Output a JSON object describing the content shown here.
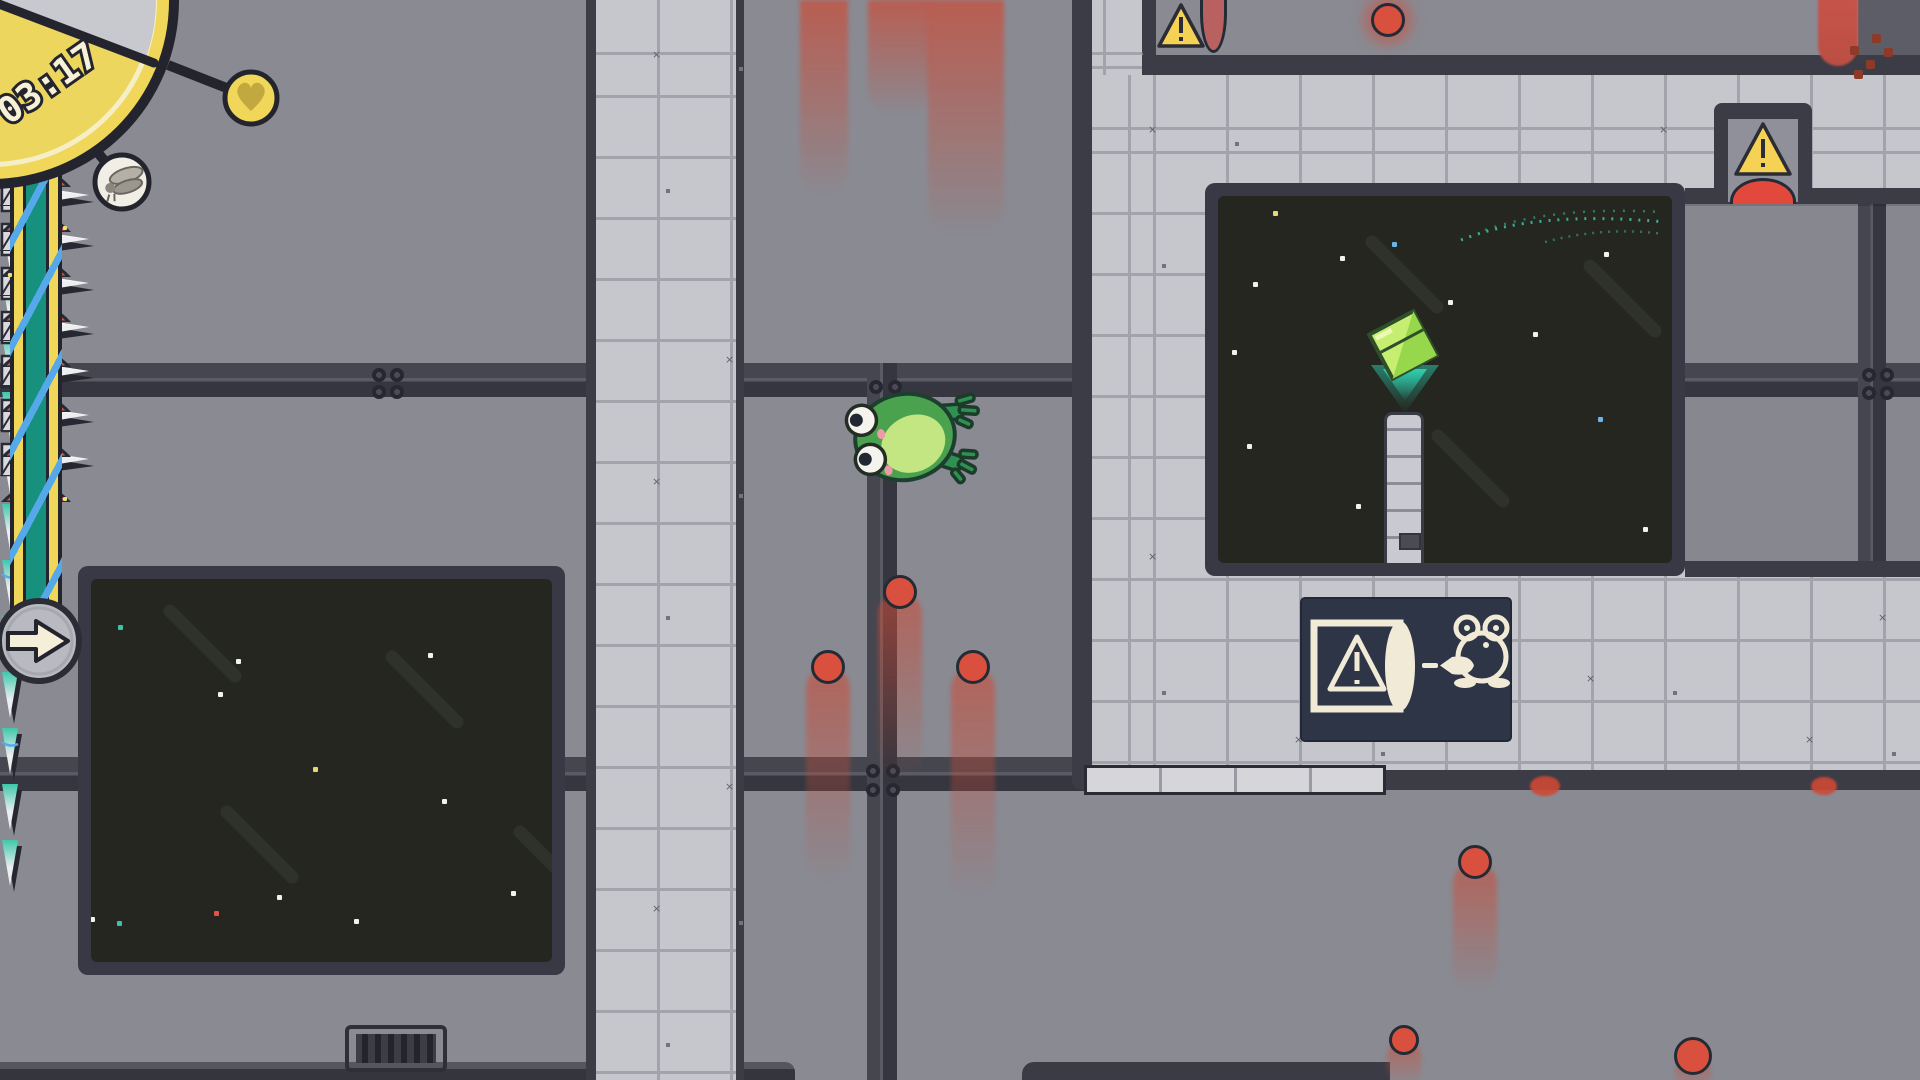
{
  "hud": {
    "timer": "03:17",
    "timer_clock_icon": "analog-clock-face",
    "heart_icon": "heart",
    "fly_icon": "fly-wings",
    "arrow_icon": "right-arrow",
    "colors": {
      "clock_face": "#ecd65e",
      "clock_ring": "#f0d75a",
      "clock_elapsed": "#c8c8cf",
      "outline": "#23242e",
      "ribbon_teal": "#17907e",
      "ribbon_stripe": "#55a8ea",
      "token_heart_fill": "#c2a93f"
    }
  },
  "sign": {
    "meaning": "warning-turret shoots projectile at frog",
    "icons": [
      "warning-cannon-box",
      "projectile",
      "frog-outline"
    ],
    "bg": "#2d3546",
    "ink": "#f1ead6"
  },
  "palette": {
    "background": "#8a8a92",
    "beam": "#3b3c45",
    "tile": "#c6c6cd",
    "tile_line": "#a2a3ab",
    "window": "#24261f",
    "spike_teal": "#3fc7ab",
    "spike_white": "#eceef0",
    "red": "#d9503f",
    "warning_yellow": "#f5d254",
    "dull_pod_red": "#b96060",
    "lens_red": "#e2493c",
    "frog_green": "#4aa24f",
    "frog_belly": "#c3e683",
    "gem_green": "#c6ee70",
    "glow_teal": "#2ed8b8"
  },
  "scene": {
    "projectiles": [
      {
        "x": 900,
        "y": 592,
        "r": 17,
        "trail": 190,
        "tw": 44
      },
      {
        "x": 828,
        "y": 667,
        "r": 17,
        "trail": 215,
        "tw": 44
      },
      {
        "x": 973,
        "y": 667,
        "r": 17,
        "trail": 230,
        "tw": 44
      },
      {
        "x": 1475,
        "y": 862,
        "r": 17,
        "trail": 130,
        "tw": 44
      },
      {
        "x": 1693,
        "y": 1056,
        "r": 19,
        "trail": 34,
        "tw": 36
      },
      {
        "x": 1404,
        "y": 1040,
        "r": 15,
        "trail": 46,
        "tw": 34
      },
      {
        "x": 1388,
        "y": 20,
        "r": 17,
        "trail": 0,
        "tw": 0,
        "glow": true
      }
    ],
    "impact_blobs": [
      {
        "x": 1545,
        "y": 786,
        "w": 30,
        "h": 20
      },
      {
        "x": 1824,
        "y": 786,
        "w": 26,
        "h": 18
      }
    ],
    "top_trails": [
      {
        "x": 800,
        "w": 48,
        "h": 195
      },
      {
        "x": 868,
        "w": 62,
        "h": 115
      },
      {
        "x": 928,
        "w": 76,
        "h": 235
      }
    ],
    "smear": {
      "x": 1818,
      "w": 40,
      "h": 66
    },
    "splatter": [
      [
        1850,
        46
      ],
      [
        1866,
        60
      ],
      [
        1884,
        48
      ],
      [
        1854,
        70
      ],
      [
        1872,
        34
      ]
    ],
    "spikes_right": [
      {
        "x": 744,
        "ys": [
          -14,
          34,
          82,
          130,
          178
        ]
      },
      {
        "x": 744,
        "ys": [
          505,
          553,
          601,
          649,
          697,
          745
        ]
      }
    ],
    "spikes_down": {
      "x0": 1090,
      "y": 790,
      "count": 16,
      "step": 18.8
    },
    "domes_left": {
      "baseline": 1080,
      "centers": [
        822,
        892,
        962
      ]
    },
    "domes_right": {
      "baseline": 1080,
      "centers": [
        1408,
        1472,
        1536,
        1600,
        1664,
        1728,
        1792,
        1856,
        1920
      ]
    },
    "stars_left": [
      {
        "x": 118,
        "y": 625,
        "c": "#3fbfae"
      },
      {
        "x": 236,
        "y": 659,
        "c": "#f2f2e9"
      },
      {
        "x": 218,
        "y": 692,
        "c": "#f2f2e9"
      },
      {
        "x": 428,
        "y": 653,
        "c": "#f2f2e9"
      },
      {
        "x": 313,
        "y": 767,
        "c": "#e8d96a"
      },
      {
        "x": 442,
        "y": 799,
        "c": "#f2f2e9"
      },
      {
        "x": 277,
        "y": 895,
        "c": "#f2f2e9"
      },
      {
        "x": 214,
        "y": 911,
        "c": "#e05548"
      },
      {
        "x": 90,
        "y": 917,
        "c": "#f2f2e9"
      },
      {
        "x": 117,
        "y": 921,
        "c": "#3fbfae"
      },
      {
        "x": 354,
        "y": 919,
        "c": "#f2f2e9"
      },
      {
        "x": 511,
        "y": 891,
        "c": "#f2f2e9"
      }
    ],
    "streaks_left": [
      {
        "x": 150,
        "y": 637
      },
      {
        "x": 372,
        "y": 683
      },
      {
        "x": 207,
        "y": 838
      },
      {
        "x": 500,
        "y": 858
      }
    ],
    "stars_right": [
      {
        "x": 1273,
        "y": 211,
        "c": "#e8d96a"
      },
      {
        "x": 1253,
        "y": 282,
        "c": "#f2f2e9"
      },
      {
        "x": 1340,
        "y": 256,
        "c": "#f2f2e9"
      },
      {
        "x": 1392,
        "y": 242,
        "c": "#6db3e8"
      },
      {
        "x": 1448,
        "y": 300,
        "c": "#f2f2e9"
      },
      {
        "x": 1533,
        "y": 332,
        "c": "#f2f2e9"
      },
      {
        "x": 1604,
        "y": 252,
        "c": "#f2f2e9"
      },
      {
        "x": 1247,
        "y": 444,
        "c": "#f2f2e9"
      },
      {
        "x": 1356,
        "y": 504,
        "c": "#f2f2e9"
      },
      {
        "x": 1598,
        "y": 417,
        "c": "#6db3e8"
      },
      {
        "x": 1501,
        "y": 498,
        "c": "#f2f2e9"
      },
      {
        "x": 1643,
        "y": 527,
        "c": "#f2f2e9"
      },
      {
        "x": 1232,
        "y": 350,
        "c": "#f2f2e9"
      }
    ],
    "streaks_right": [
      {
        "x": 1352,
        "y": 268
      },
      {
        "x": 1570,
        "y": 292
      },
      {
        "x": 1418,
        "y": 462
      }
    ],
    "bolts": [
      [
        372,
        368
      ],
      [
        390,
        368
      ],
      [
        372,
        385
      ],
      [
        390,
        385
      ],
      [
        869,
        380
      ],
      [
        888,
        380
      ],
      [
        866,
        764
      ],
      [
        886,
        764
      ],
      [
        866,
        783
      ],
      [
        886,
        783
      ]
    ],
    "corridor_bolts": [
      [
        177,
        172
      ],
      [
        195,
        172
      ],
      [
        177,
        190
      ],
      [
        195,
        190
      ]
    ],
    "sparkles": [
      [
        63,
        226
      ],
      [
        8,
        273
      ],
      [
        63,
        497
      ]
    ]
  }
}
